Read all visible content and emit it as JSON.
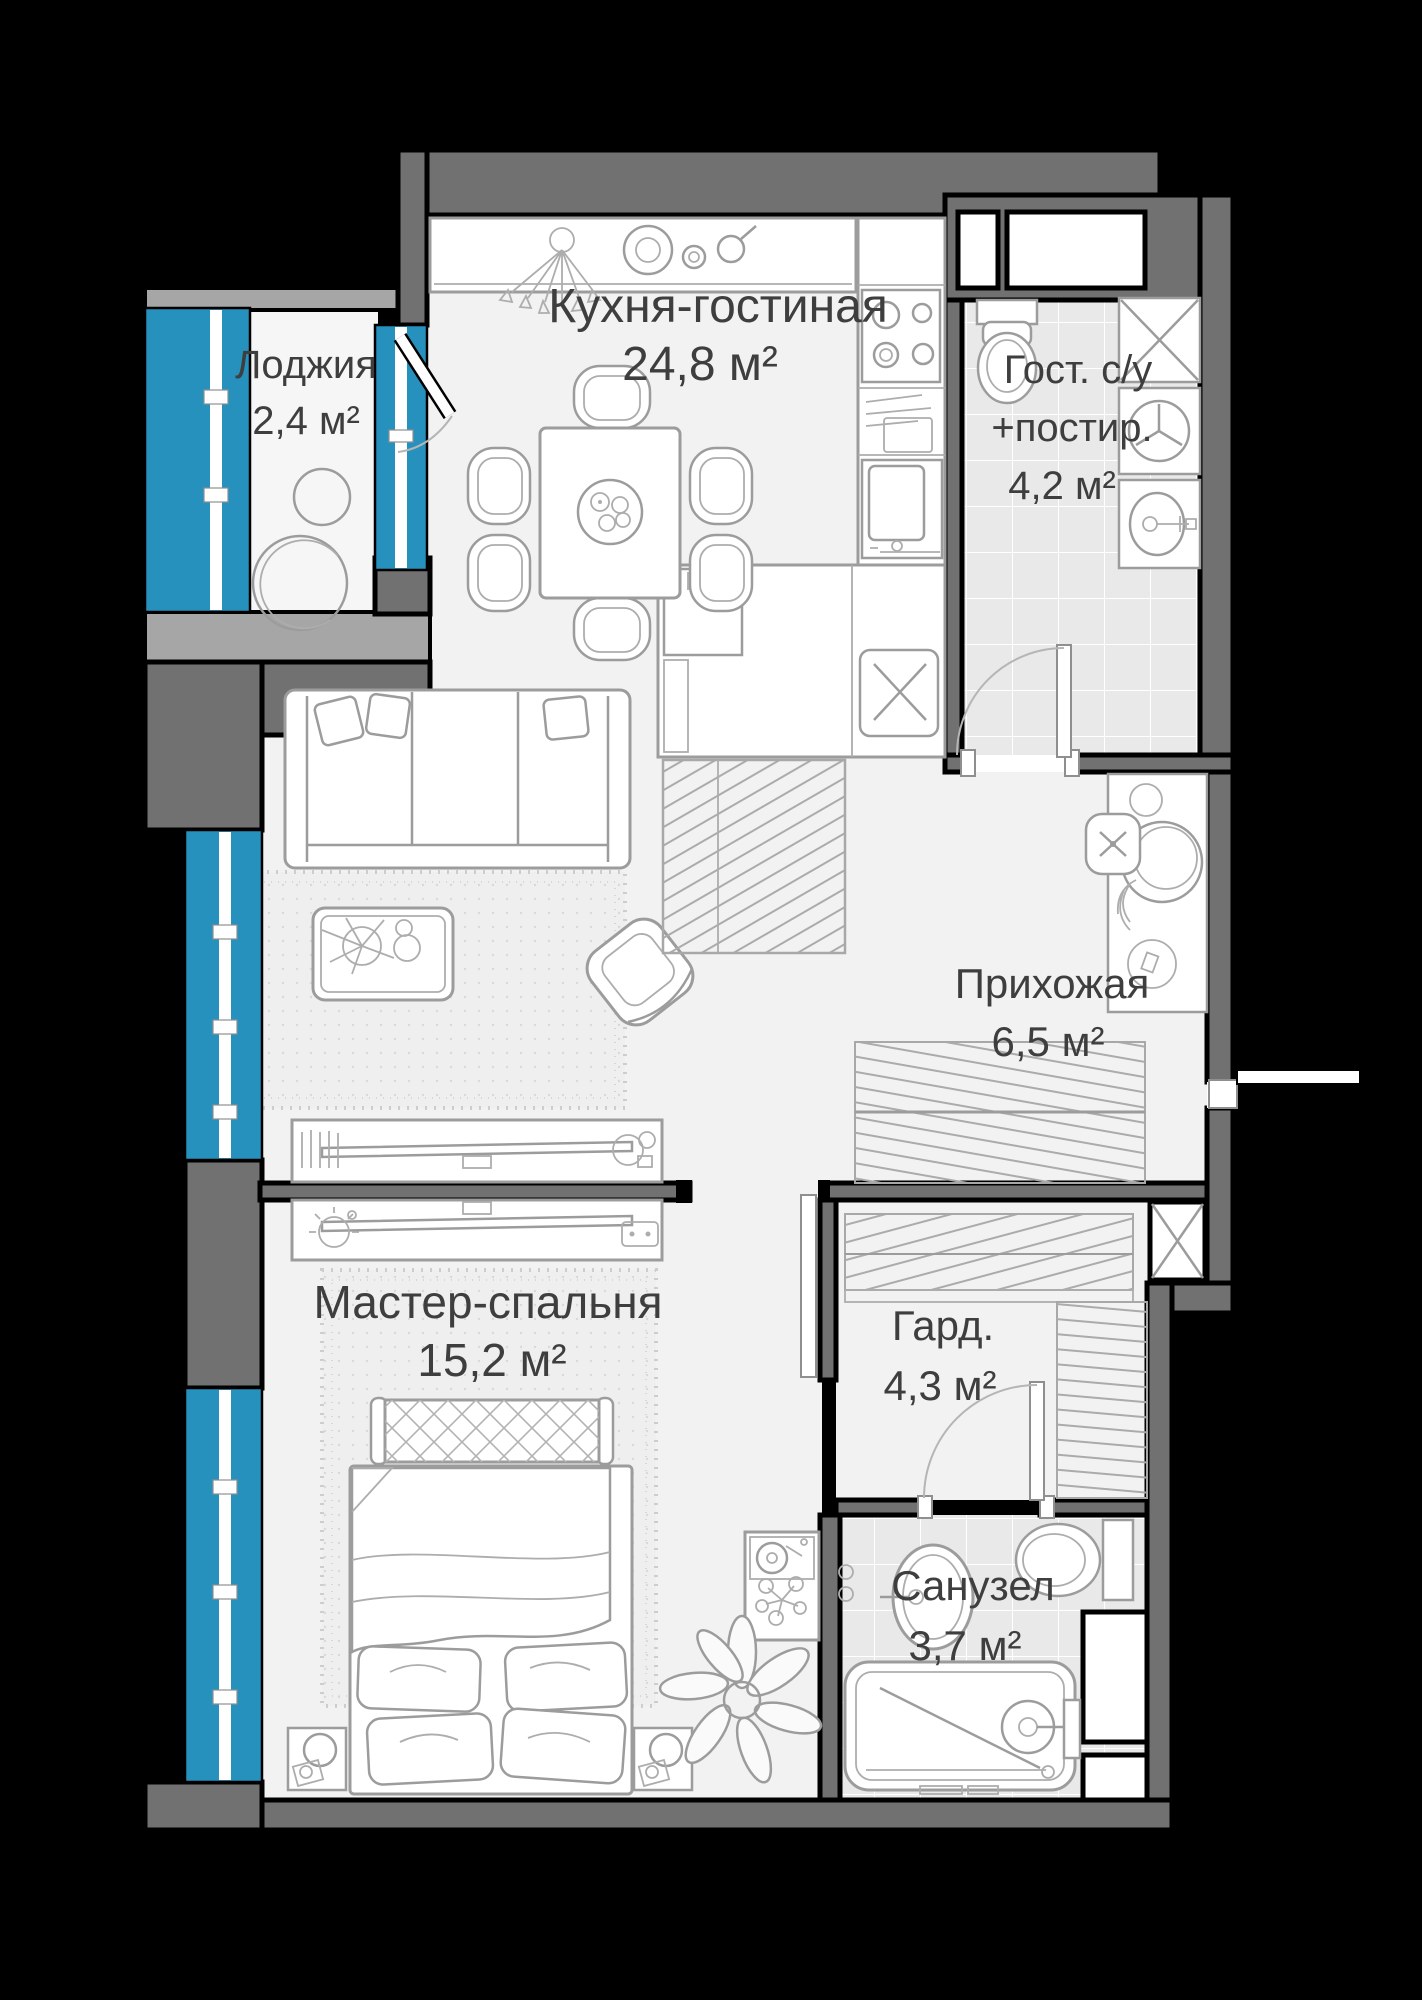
{
  "floorplan": {
    "rooms": [
      {
        "id": "loggia",
        "name": "Лоджия",
        "area": "2,4 м²"
      },
      {
        "id": "kitchen_living",
        "name": "Кухня-гостиная",
        "area": "24,8 м²"
      },
      {
        "id": "guest_bath",
        "name": "Гост. с/у",
        "name_line2": "+постир.",
        "area": "4,2 м²"
      },
      {
        "id": "hallway",
        "name": "Прихожая",
        "area": "6,5 м²"
      },
      {
        "id": "master_bedroom",
        "name": "Мастер-спальня",
        "area": "15,2 м²"
      },
      {
        "id": "wardrobe",
        "name": "Гард.",
        "area": "4,3 м²"
      },
      {
        "id": "bathroom",
        "name": "Санузел",
        "area": "3,7 м²"
      }
    ],
    "colors": {
      "background": "#000000",
      "wall": "#717171",
      "loggia_wall": "#A6A6A6",
      "window": "#2791BE",
      "floor": "#F2F2F2",
      "tile_floor": "#E9E9E9",
      "furniture_line": "#9C9C9C",
      "label_text": "#3E3E3E"
    }
  }
}
